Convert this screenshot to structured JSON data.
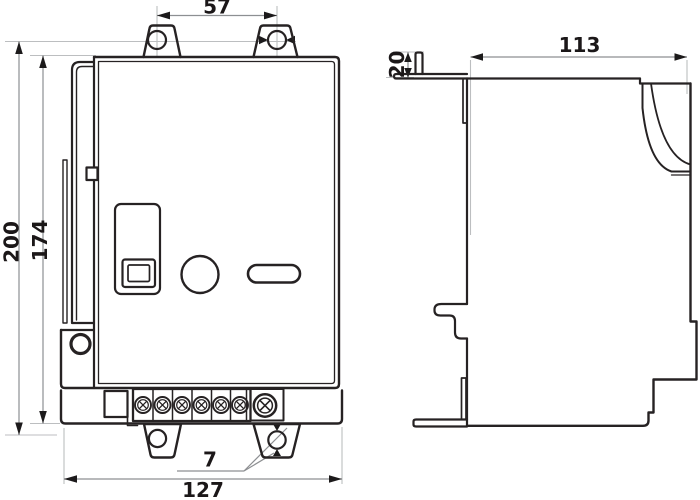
{
  "drawing": {
    "type": "technical-dimension-drawing",
    "dims": {
      "hole_spacing_top": "57",
      "overall_height": "200",
      "body_height": "174",
      "depth": "113",
      "tab_height": "20",
      "hole_diameter": "7",
      "overall_width": "127"
    },
    "colors": {
      "line": "#262223",
      "dim_line": "#8d8f92",
      "extension_line": "#bcbec0",
      "text": "#1b1718",
      "background": "#ffffff"
    }
  }
}
